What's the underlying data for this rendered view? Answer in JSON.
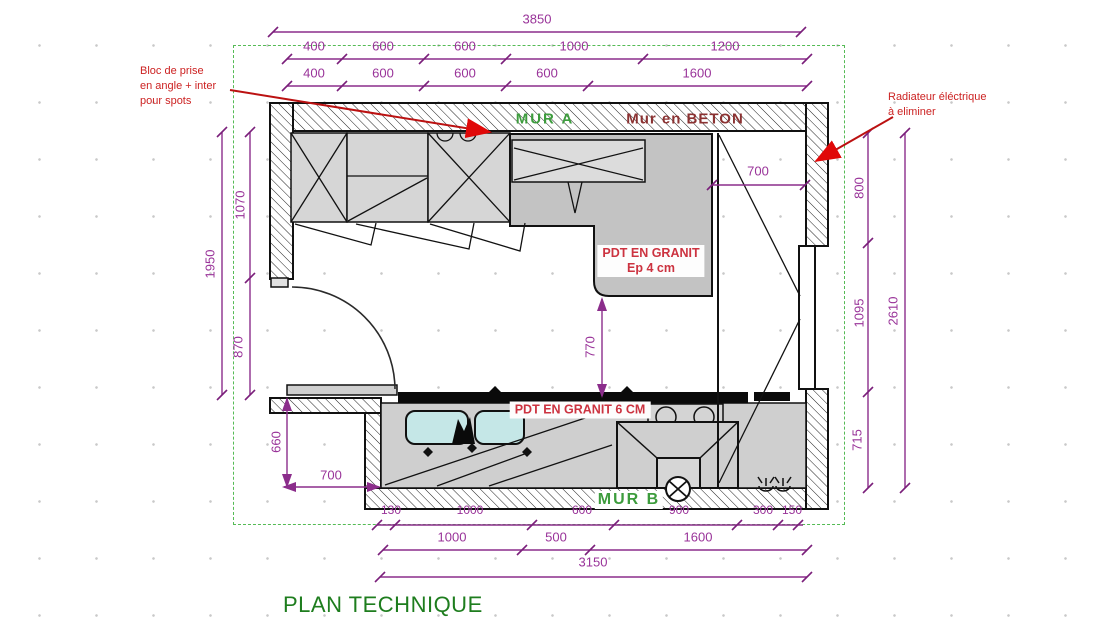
{
  "title": "PLAN TECHNIQUE",
  "wall_labels": {
    "mur_a": "MUR A",
    "mur_en_beton": "Mur en BETON",
    "mur_b": "MUR B"
  },
  "material_labels": {
    "granit_top_line1": "PDT EN GRANIT",
    "granit_top_line2": "Ep 4 cm",
    "granit_bottom": "PDT EN GRANIT 6 CM"
  },
  "annotations": {
    "bloc_prise": [
      "Bloc de prise",
      "en angle + inter",
      "pour spots"
    ],
    "radiateur": [
      "Radiateur éléctrique",
      "à eliminer"
    ]
  },
  "dimensions": {
    "top_total": "3850",
    "top_row2": [
      "400",
      "600",
      "600",
      "1000",
      "1200"
    ],
    "top_row3": [
      "400",
      "600",
      "600",
      "600",
      "1600"
    ],
    "window_width": "700",
    "right_segments": [
      "800",
      "1095",
      "715"
    ],
    "right_total": "2610",
    "left_segments": [
      "1070",
      "870"
    ],
    "left_total": "1950",
    "door_wall_height": "660",
    "door_wall_width": "700",
    "counter_depth": "770",
    "bottom_row1": [
      "130",
      "1000",
      "600",
      "900",
      "300",
      "150"
    ],
    "bottom_row2": [
      "1000",
      "500",
      "1600"
    ],
    "bottom_total": "3150"
  },
  "colors": {
    "dimension_purple": "#993399",
    "wall_label_green": "#3d9c3d",
    "concrete_label_red": "#8b3232",
    "annotation_red": "#cc2222",
    "title_green": "#1e7d1e",
    "granite_fill": "#c3c3c3",
    "cabinet_fill": "#d6d6d6",
    "sink_fill": "#c5e7e7",
    "plan_border_green": "#55bb55"
  }
}
